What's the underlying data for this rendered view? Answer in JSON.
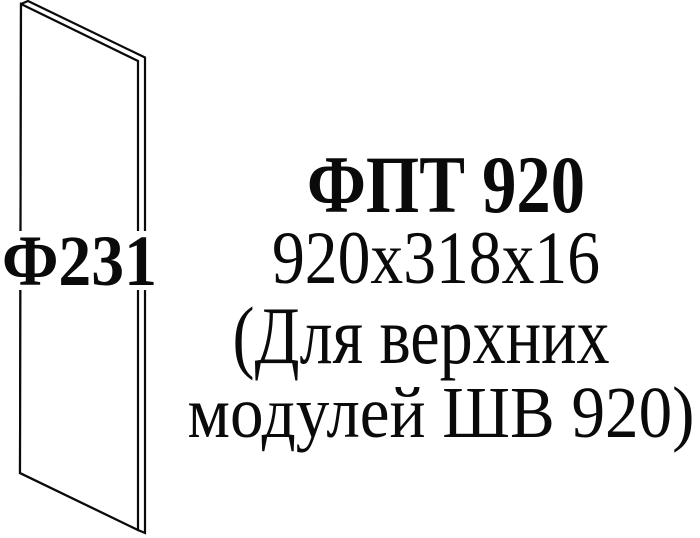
{
  "colors": {
    "background": "#ffffff",
    "ink": "#0a0a0a"
  },
  "diagram": {
    "panel_label": "Ф231"
  },
  "caption": {
    "title": "ФПТ 920",
    "dimensions": "920x318x16",
    "note_line1": "(Для верхних",
    "note_line2": "модулей ШВ 920)"
  }
}
